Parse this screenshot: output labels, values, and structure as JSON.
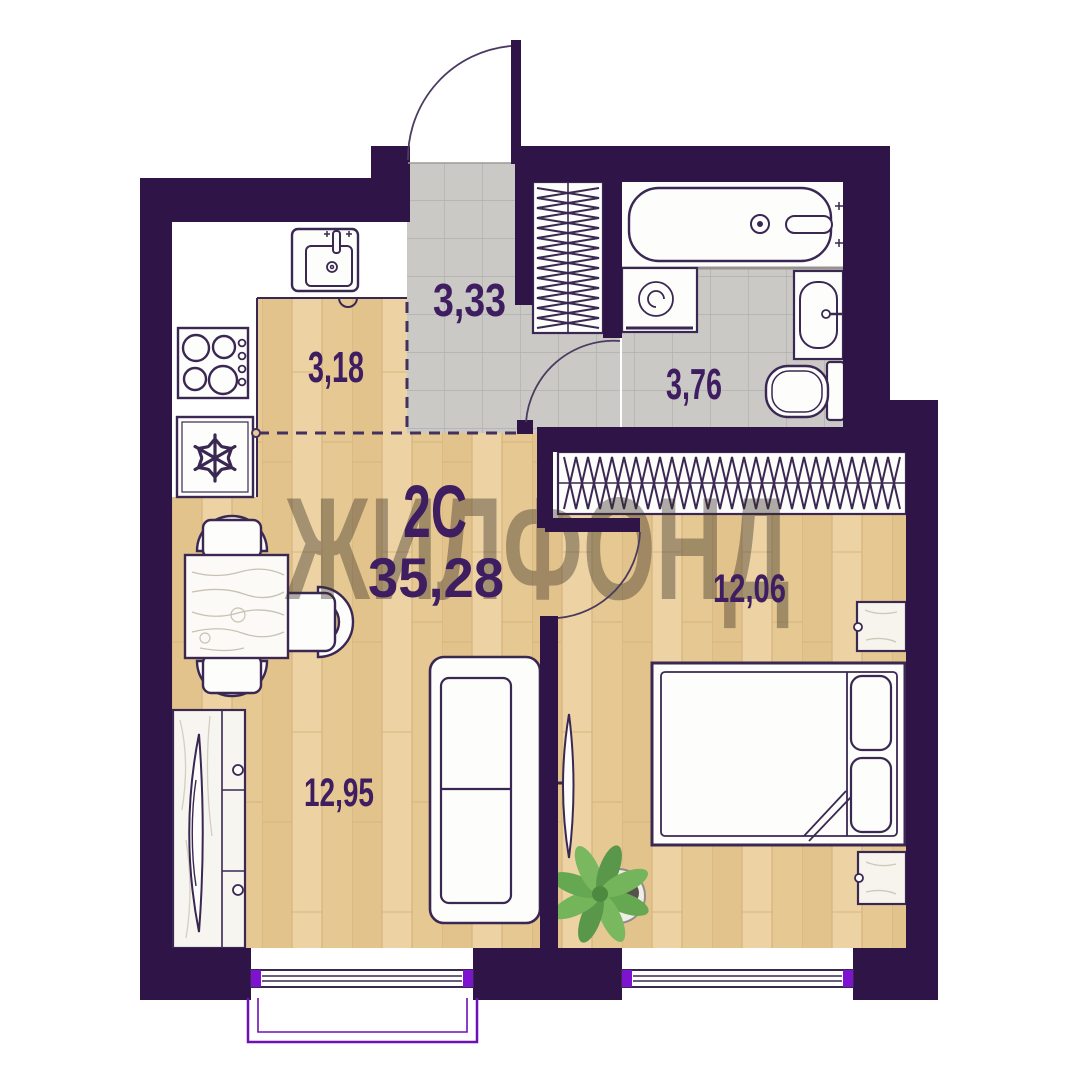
{
  "plan": {
    "type_label": "2С",
    "total_area": "35,28",
    "watermark": "ЖИЛФОНД",
    "rooms": [
      {
        "name": "kitchen",
        "area": "3,18"
      },
      {
        "name": "hallway",
        "area": "3,33"
      },
      {
        "name": "bathroom",
        "area": "3,76"
      },
      {
        "name": "bedroom",
        "area": "12,06"
      },
      {
        "name": "living-room",
        "area": "12,95"
      }
    ],
    "colors": {
      "wall": "#2f1547",
      "window_accent": "#7d12cf",
      "balcony_outline": "#6d10b8",
      "label": "#3e1e60",
      "wood_floor": "#e8cb97",
      "tile_floor": "#cac9c6"
    }
  }
}
